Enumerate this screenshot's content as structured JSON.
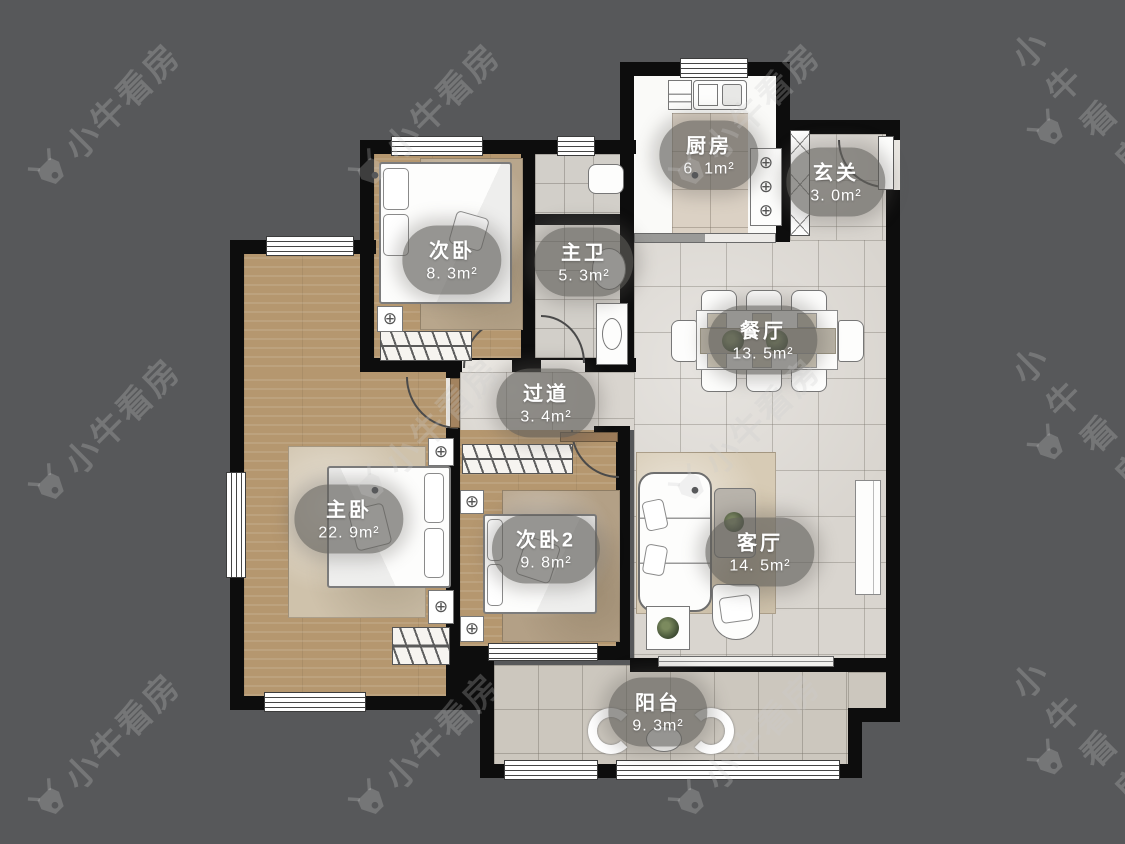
{
  "watermark": {
    "text": "小牛看房"
  },
  "rooms": {
    "kitchen": {
      "label": "厨房",
      "area": "6. 1m²"
    },
    "entry": {
      "label": "玄关",
      "area": "3. 0m²"
    },
    "bedroom2": {
      "label": "次卧",
      "area": "8. 3m²"
    },
    "master_bath": {
      "label": "主卫",
      "area": "5. 3m²"
    },
    "dining": {
      "label": "餐厅",
      "area": "13. 5m²"
    },
    "hallway": {
      "label": "过道",
      "area": "3. 4m²"
    },
    "master_bedroom": {
      "label": "主卧",
      "area": "22. 9m²"
    },
    "bedroom3": {
      "label": "次卧2",
      "area": "9. 8m²"
    },
    "living": {
      "label": "客厅",
      "area": "14. 5m²"
    },
    "balcony": {
      "label": "阳台",
      "area": "9. 3m²"
    }
  }
}
